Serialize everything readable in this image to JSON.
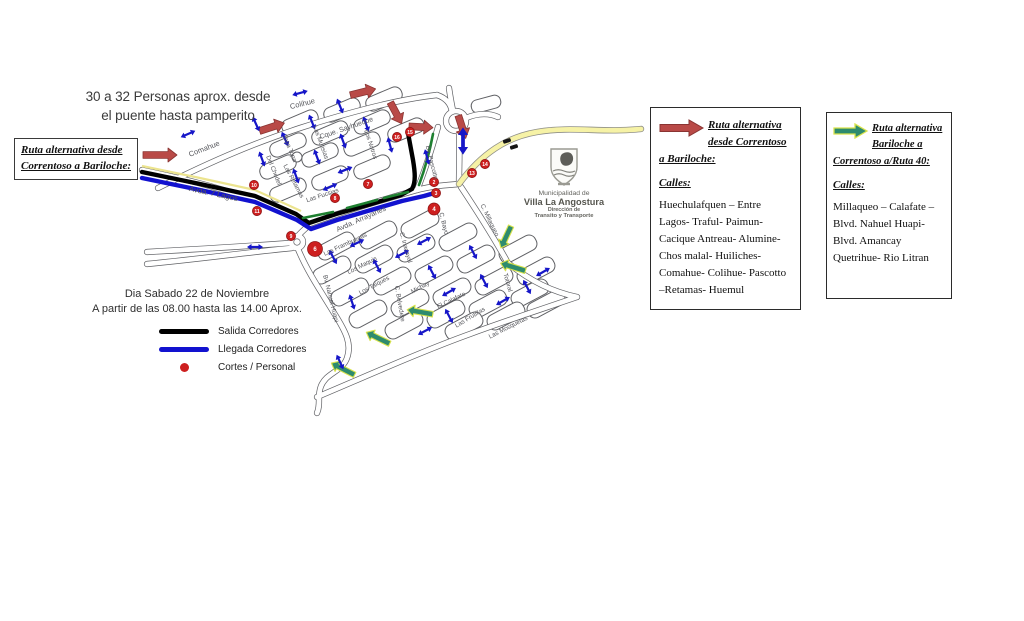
{
  "annotations": {
    "top_note_line1": "30 a 32 Personas aprox. desde",
    "top_note_line2": "el puente hasta pamperito",
    "left_box_line1": "Ruta alternativa desde",
    "left_box_line2": "Correntoso a Bariloche:",
    "date_line1": "Dia Sabado 22 de Noviembre",
    "date_line2": "A partir de las 08.00 hasta las 14.00 Aprox."
  },
  "legend": {
    "items": [
      {
        "swatch": "black-line",
        "color": "#000000",
        "label": "Salida Corredores"
      },
      {
        "swatch": "blue-line",
        "color": "#1212cf",
        "label": "Llegada Corredores"
      },
      {
        "swatch": "red-dot",
        "color": "#cd1f1f",
        "label": "Cortes / Personal"
      }
    ]
  },
  "logo": {
    "line1": "Municipalidad de",
    "line2": "Villa La Angostura",
    "line3": "Dirección de",
    "line4": "Transito y Transporte"
  },
  "info_boxes": [
    {
      "arrow_icon": "red-route-arrow",
      "arrow_color": "#b94a47",
      "heading": "Ruta alternativa desde Correntoso a Bariloche:",
      "calles_label": "Calles:",
      "streets_text": "Huechulafquen – Entre Lagos- Traful- Paimun- Cacique Antreau- Alumine- Chos malal- Huiliches- Comahue- Colihue- Pascotto –Retamas- Huemul"
    },
    {
      "arrow_icon": "green-route-arrow",
      "arrow_color": "#2e8b6e",
      "heading": "Ruta alternativa Bariloche a Correntoso a/Ruta 40:",
      "calles_label": "Calles:",
      "streets_text": "Millaqueo – Calafate – Blvd. Nahuel Huapi- Blvd. Amancay Quetrihue- Rio Litran"
    }
  ],
  "map": {
    "colors": {
      "salida_route": "#000000",
      "llegada_route": "#1212cf",
      "alt_route_red": "#b94a47",
      "alt_route_green": "#2e8b6e",
      "two_way_arrow": "#1616c8",
      "corte_dot": "#cd1f1f",
      "ruta40_yellow": "#f6f2a6"
    },
    "streets": [
      {
        "name": "Comahue",
        "x": 205,
        "y": 151,
        "r": -21,
        "s": 7.5
      },
      {
        "name": "Colihue",
        "x": 303,
        "y": 106,
        "r": -14,
        "s": 7.5
      },
      {
        "name": "Cque. Sayhueque",
        "x": 347,
        "y": 130,
        "r": -19,
        "s": 7
      },
      {
        "name": "Topa Topa",
        "x": 288,
        "y": 149,
        "r": 68,
        "s": 6.3
      },
      {
        "name": "Las Mutisias",
        "x": 319,
        "y": 143,
        "r": 70,
        "s": 6.3
      },
      {
        "name": "Del Chedel",
        "x": 272,
        "y": 171,
        "r": 68,
        "s": 6.3
      },
      {
        "name": "Las Retamas",
        "x": 292,
        "y": 182,
        "r": 62,
        "s": 6.3
      },
      {
        "name": "Las Fucsias",
        "x": 323,
        "y": 197,
        "r": -18,
        "s": 6.3
      },
      {
        "name": "Los Notros",
        "x": 369,
        "y": 145,
        "r": 72,
        "s": 6.3
      },
      {
        "name": "Bv. Pascotto",
        "x": 430,
        "y": 163,
        "r": 76,
        "s": 6.3
      },
      {
        "name": "Avda. 7 Lagos",
        "x": 213,
        "y": 196,
        "r": 12,
        "s": 7.8
      },
      {
        "name": "Avda. Arrayanes",
        "x": 362,
        "y": 221,
        "r": -24,
        "s": 7.3
      },
      {
        "name": "Las Frambuesas",
        "x": 346,
        "y": 246,
        "r": -25,
        "s": 6.3
      },
      {
        "name": "Los Maquis",
        "x": 363,
        "y": 267,
        "r": -27,
        "s": 6.3
      },
      {
        "name": "Los Taiques",
        "x": 375,
        "y": 287,
        "r": -28,
        "s": 6.3
      },
      {
        "name": "C. Inacayal",
        "x": 404,
        "y": 248,
        "r": 74,
        "s": 6.3
      },
      {
        "name": "C. Belvedere",
        "x": 398,
        "y": 304,
        "r": 80,
        "s": 6.3
      },
      {
        "name": "Michay",
        "x": 421,
        "y": 289,
        "r": -28,
        "s": 6.3
      },
      {
        "name": "C. Bayo",
        "x": 442,
        "y": 224,
        "r": 76,
        "s": 6.3
      },
      {
        "name": "El Calafate",
        "x": 452,
        "y": 302,
        "r": -26,
        "s": 6.3
      },
      {
        "name": "Las Frutillas",
        "x": 471,
        "y": 319,
        "r": -31,
        "s": 6.3
      },
      {
        "name": "Totoral",
        "x": 506,
        "y": 283,
        "r": 74,
        "s": 6.3
      },
      {
        "name": "Las Mosquetas",
        "x": 509,
        "y": 329,
        "r": -27,
        "s": 6.3
      },
      {
        "name": "C. Millaqueo",
        "x": 488,
        "y": 221,
        "r": 64,
        "s": 6.3
      },
      {
        "name": "Bv. Nahuel Huapi",
        "x": 329,
        "y": 299,
        "r": 76,
        "s": 6.3
      }
    ],
    "cuts": [
      {
        "n": "2",
        "x": 434,
        "y": 182,
        "r": 4.6
      },
      {
        "n": "3",
        "x": 436,
        "y": 193,
        "r": 4.6
      },
      {
        "n": "4",
        "x": 434,
        "y": 209,
        "r": 6
      },
      {
        "n": "6",
        "x": 315,
        "y": 249,
        "r": 7.5
      },
      {
        "n": "7",
        "x": 368,
        "y": 184,
        "r": 4.6
      },
      {
        "n": "8",
        "x": 335,
        "y": 198,
        "r": 4.6
      },
      {
        "n": "9",
        "x": 291,
        "y": 236,
        "r": 4.6
      },
      {
        "n": "10",
        "x": 254,
        "y": 185,
        "r": 4.6
      },
      {
        "n": "11",
        "x": 257,
        "y": 211,
        "r": 4.6
      },
      {
        "n": "13",
        "x": 472,
        "y": 173,
        "r": 4.6
      },
      {
        "n": "14",
        "x": 485,
        "y": 164,
        "r": 4.6
      },
      {
        "n": "15",
        "x": 410,
        "y": 132,
        "r": 4.6
      },
      {
        "n": "16",
        "x": 397,
        "y": 137,
        "r": 4.6
      }
    ],
    "red_arrows": [
      {
        "x": 160,
        "y": 155,
        "rot": 0,
        "len": 34
      },
      {
        "x": 272,
        "y": 127,
        "rot": -18,
        "len": 26
      },
      {
        "x": 363,
        "y": 92,
        "rot": -14,
        "len": 26
      },
      {
        "x": 396,
        "y": 113,
        "rot": 62,
        "len": 24
      },
      {
        "x": 421,
        "y": 127,
        "rot": 3,
        "len": 24
      },
      {
        "x": 462,
        "y": 127,
        "rot": 72,
        "len": 24
      }
    ],
    "green_arrows": [
      {
        "x": 506,
        "y": 237,
        "rot": 115,
        "len": 24
      },
      {
        "x": 513,
        "y": 267,
        "rot": 197,
        "len": 26
      },
      {
        "x": 420,
        "y": 312,
        "rot": 190,
        "len": 26
      },
      {
        "x": 378,
        "y": 338,
        "rot": 206,
        "len": 26
      },
      {
        "x": 343,
        "y": 369,
        "rot": 207,
        "len": 26
      }
    ],
    "blue_arrows": [
      {
        "x": 188,
        "y": 134,
        "rot": -24
      },
      {
        "x": 256,
        "y": 124,
        "rot": 66
      },
      {
        "x": 300,
        "y": 93,
        "rot": -15
      },
      {
        "x": 285,
        "y": 139,
        "rot": 66
      },
      {
        "x": 312,
        "y": 122,
        "rot": 68
      },
      {
        "x": 340,
        "y": 106,
        "rot": 68
      },
      {
        "x": 262,
        "y": 159,
        "rot": 70
      },
      {
        "x": 317,
        "y": 157,
        "rot": 70
      },
      {
        "x": 343,
        "y": 141,
        "rot": 70
      },
      {
        "x": 366,
        "y": 124,
        "rot": 70
      },
      {
        "x": 345,
        "y": 170,
        "rot": -22
      },
      {
        "x": 390,
        "y": 145,
        "rot": 75
      },
      {
        "x": 330,
        "y": 187,
        "rot": -24
      },
      {
        "x": 296,
        "y": 176,
        "rot": 70
      },
      {
        "x": 427,
        "y": 157,
        "rot": 75
      },
      {
        "x": 333,
        "y": 257,
        "rot": 62
      },
      {
        "x": 357,
        "y": 243,
        "rot": -26
      },
      {
        "x": 377,
        "y": 266,
        "rot": 62
      },
      {
        "x": 402,
        "y": 254,
        "rot": -28
      },
      {
        "x": 424,
        "y": 241,
        "rot": -28
      },
      {
        "x": 432,
        "y": 272,
        "rot": 62
      },
      {
        "x": 449,
        "y": 292,
        "rot": -30
      },
      {
        "x": 473,
        "y": 252,
        "rot": 62
      },
      {
        "x": 484,
        "y": 281,
        "rot": 62
      },
      {
        "x": 503,
        "y": 301,
        "rot": -30
      },
      {
        "x": 527,
        "y": 287,
        "rot": 62
      },
      {
        "x": 449,
        "y": 316,
        "rot": 62
      },
      {
        "x": 425,
        "y": 331,
        "rot": -28
      },
      {
        "x": 352,
        "y": 302,
        "rot": 72
      },
      {
        "x": 340,
        "y": 362,
        "rot": 65
      },
      {
        "x": 255,
        "y": 247,
        "rot": 0
      },
      {
        "x": 543,
        "y": 272,
        "rot": -30
      },
      {
        "x": 463,
        "y": 141,
        "rot": 90,
        "s": 1.7
      }
    ],
    "cars": [
      {
        "x": 507,
        "y": 141,
        "rot": -18
      },
      {
        "x": 514,
        "y": 147,
        "rot": -18
      }
    ]
  }
}
